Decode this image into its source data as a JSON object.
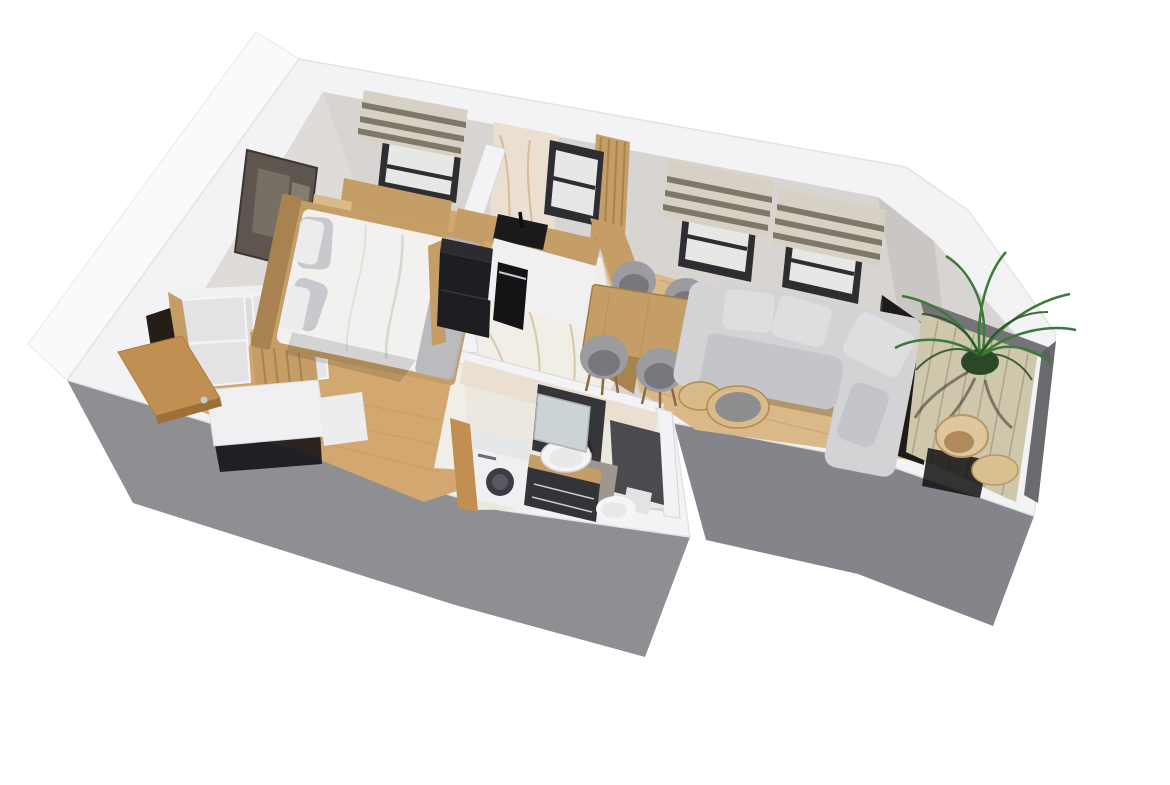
{
  "meta": {
    "title": "3D axonometric apartment floor plan render",
    "render_style": "isometric cutaway, white background",
    "canvas": {
      "width": 1170,
      "height": 785
    }
  },
  "scene": {
    "rooms": [
      {
        "name": "bedroom",
        "floor": "light oak",
        "items": [
          "double-bed",
          "gray-pillows",
          "wood-headboard",
          "nightstand",
          "wall-bench",
          "abstract-wall-art",
          "window-with-roman-blind"
        ]
      },
      {
        "name": "hallway-entry",
        "floor": "light oak",
        "items": [
          "open-white-wardrobe",
          "wood-slat-screen",
          "white-sideboard",
          "entrance-door-open"
        ]
      },
      {
        "name": "kitchen",
        "floor": "white marble",
        "items": [
          "l-shaped-oak-counter",
          "black-sink",
          "black-faucet",
          "black-oven",
          "black-fridge",
          "marble-backsplash-wall",
          "small-window",
          "wood-slat-partition",
          "oak-bar-counter"
        ]
      },
      {
        "name": "living-dining",
        "floor": "oak",
        "items": [
          "oak-dining-table",
          "four-gray-chairs",
          "gray-corner-sofa",
          "nesting-round-coffee-tables",
          "dark-tv-panel",
          "two-windows-with-roman-blinds",
          "chamfered-corner-wall"
        ]
      },
      {
        "name": "bathroom",
        "floor": "marble and gray tile",
        "items": [
          "washing-machine",
          "dark-vanity-with-round-vessel-sink",
          "mirror",
          "toilet",
          "dark-tile-wall",
          "wood-door"
        ]
      },
      {
        "name": "balcony",
        "floor": "wood decking",
        "items": [
          "potted-palm-plant",
          "curved-wood-lounge-chair",
          "round-wood-side-table",
          "glass-balustrade"
        ]
      }
    ]
  },
  "colors": {
    "background": "#ffffff",
    "wallTop": "#f3f3f5",
    "wallEdge": "#dfdfe2",
    "wallOuterBright": "#fafafb",
    "exteriorGray": "#8e8f92",
    "exteriorGrayDark": "#84858a",
    "interiorWall": "#d7d4d1",
    "interiorWallShade": "#c9c6c3",
    "westWallFace": "#dedbd8",
    "woodFloor": "#d2a870",
    "woodFloorLight": "#dbb887",
    "plankLine": "#b08c55",
    "marbleFloor": "#f1eee8",
    "marbleVein": "#c2a16e",
    "marbleWall": "#eadfd0",
    "woodFurniture": "#c59d66",
    "woodDark": "#a8824f",
    "woodLight": "#d9bb8a",
    "blindLight": "#d7d1c5",
    "blindDark": "#7f7869",
    "windowFrame": "#2e2e32",
    "glass": "#e7e7e5",
    "bedding": "#f2f1ef",
    "beddingShade": "#e0dfdd",
    "pillowGray": "#c9c9cd",
    "pillowWhite": "#ececee",
    "bedThrow": "#b5b5b9",
    "sofa": "#d3d3d6",
    "sofaShade": "#c5c5c9",
    "cushion": "#dedee1",
    "chairGray": "#9b9ba0",
    "chairSeat": "#77777d",
    "chairLeg": "#8a6a40",
    "whiteFurniture": "#f0f0f2",
    "furnitureShadow": "#111114",
    "fridgeBlack": "#1e1e22",
    "applianceBlack": "#141417",
    "sinkBlack": "#1a1a1d",
    "artDark": "#5e564e",
    "artMid": "#776e64",
    "artLight": "#8d847a",
    "bathBase": "#ece7df",
    "bathDarkTile": "#4a4a4f",
    "bathPanel": "#35353a",
    "floorTileGray": "#9d978e",
    "mirror": "#ccd3d6",
    "toiletWhite": "#f5f5f7",
    "machineWhite": "#eff0f2",
    "machineTop": "#e6e7e9",
    "machineDoor": "#3c3c42",
    "deck": "#cfc7ac",
    "deckLine": "#a39b80",
    "balustrade": "#737378",
    "balustradeDark": "#5c5c60",
    "plantGreen": "#3c7a38",
    "plantDarkGreen": "#274f24",
    "plantShadow": "#2e2b20",
    "potGreen": "#2c4629",
    "balconyWoodChair": "#dec69d",
    "balconyWoodTable": "#d8c08f",
    "tvPanel": "#1d1b1a",
    "doorWood": "#c28f52",
    "doorWoodDark": "#9e7038",
    "handleSilver": "#c9cacd",
    "darkOpening": "#241e17"
  }
}
